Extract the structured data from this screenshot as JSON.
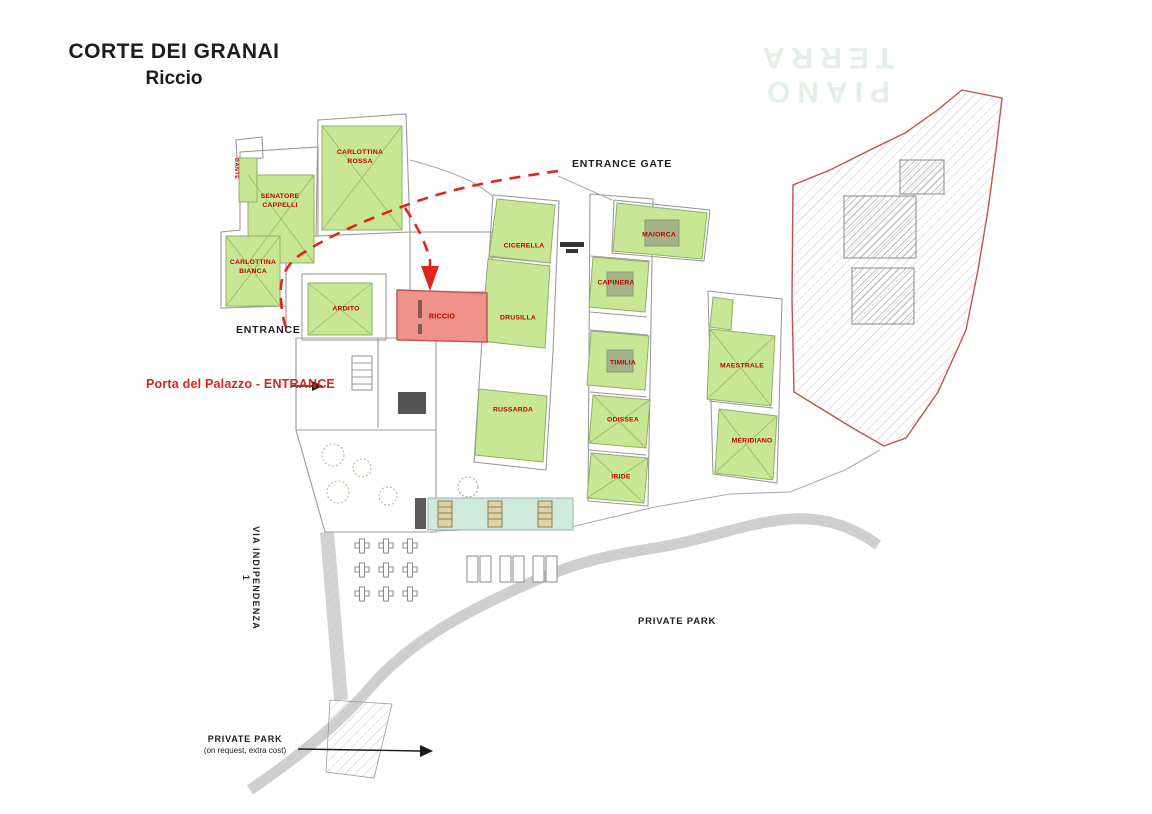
{
  "title": {
    "line1": "CORTE DEI GRANAI",
    "line2": "Riccio"
  },
  "watermark": "PIANO TERRA",
  "plan": {
    "highlight_unit": "RICCIO",
    "units": [
      {
        "id": "carlottina-rossa",
        "label": "CARLOTTINA ROSSA",
        "color": "green"
      },
      {
        "id": "senatore-cappelli",
        "label": "SENATORE CAPPELLI",
        "color": "green"
      },
      {
        "id": "carlottina-bianca",
        "label": "CARLOTTINA BIANCA",
        "color": "green"
      },
      {
        "id": "dante",
        "label": "DANTE",
        "color": "green"
      },
      {
        "id": "ardito",
        "label": "ARDITO",
        "color": "green"
      },
      {
        "id": "riccio",
        "label": "RICCIO",
        "color": "highlight"
      },
      {
        "id": "cicerella",
        "label": "CICERELLA",
        "color": "green"
      },
      {
        "id": "drusilla",
        "label": "DRUSILLA",
        "color": "green"
      },
      {
        "id": "russarda",
        "label": "RUSSARDA",
        "color": "green"
      },
      {
        "id": "maiorca",
        "label": "MAIORCA",
        "color": "green"
      },
      {
        "id": "capinera",
        "label": "CAPINERA",
        "color": "green"
      },
      {
        "id": "timilia",
        "label": "TIMILIA",
        "color": "green"
      },
      {
        "id": "odissea",
        "label": "ODISSEA",
        "color": "green"
      },
      {
        "id": "iride",
        "label": "IRIDE",
        "color": "green"
      },
      {
        "id": "maestrale",
        "label": "MAESTRALE",
        "color": "green"
      },
      {
        "id": "meridiano",
        "label": "MERIDIANO",
        "color": "green"
      }
    ]
  },
  "labels": {
    "entrance": "ENTRANCE",
    "entrance_gate": "ENTRANCE GATE",
    "porta_entrance": "Porta del Palazzo - ENTRANCE",
    "via": "VIA INDIPENDENZA 1",
    "private_park": "PRIVATE PARK",
    "private_park_note1": "PRIVATE PARK",
    "private_park_note2": "(on request, extra cost)"
  },
  "colors": {
    "unit_green": "#c8e795",
    "unit_highlight": "#f0928c",
    "label_red": "#c00000",
    "route_red": "#e0251c",
    "area_outline_red": "#c4524a",
    "plan_gray": "#9b9b9b",
    "watermark_green": "#e4efe8",
    "pool_teal": "#cfe9dc"
  }
}
